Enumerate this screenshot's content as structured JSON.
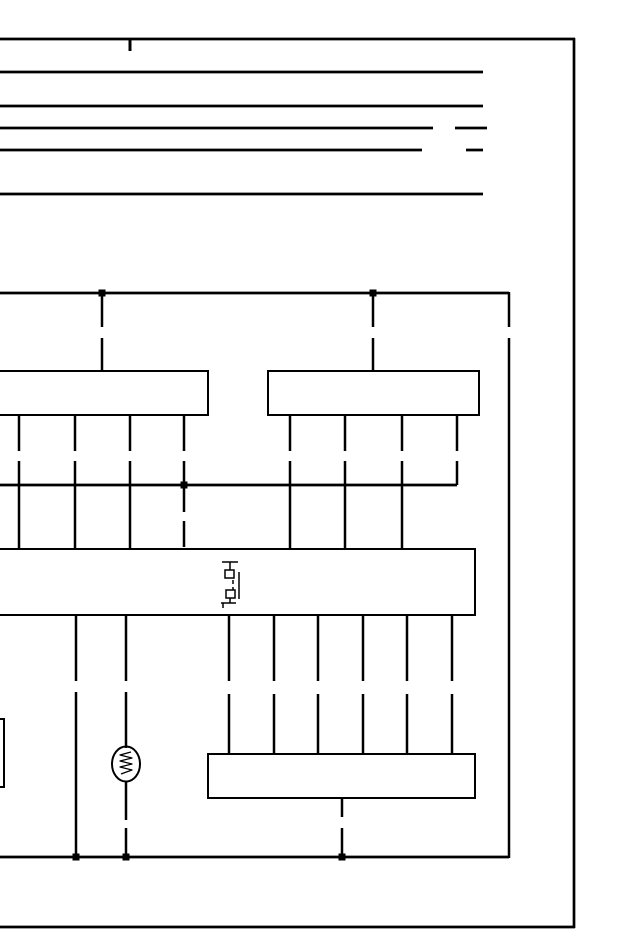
{
  "page": {
    "kind": "wiring-diagram-schematic",
    "background_color": "#ffffff",
    "line_color": "#000000"
  },
  "diagram": {
    "canvas": {
      "width": 640,
      "height": 950
    },
    "elements": [
      {
        "name": "page-border-top",
        "type": "line",
        "x1": 0,
        "y1": 39,
        "x2": 575,
        "y2": 39,
        "sw": 2.7
      },
      {
        "name": "page-border-right",
        "type": "line",
        "x1": 574,
        "y1": 38,
        "x2": 574,
        "y2": 928,
        "sw": 2.7
      },
      {
        "name": "page-border-bottom",
        "type": "line",
        "x1": 0,
        "y1": 927,
        "x2": 575,
        "y2": 927,
        "sw": 2.7
      },
      {
        "name": "top-border-tick",
        "type": "line",
        "x1": 130,
        "y1": 39,
        "x2": 130,
        "y2": 51,
        "sw": 3
      },
      {
        "name": "bus-line-1",
        "type": "line",
        "x1": 0,
        "y1": 72,
        "x2": 483,
        "y2": 72,
        "sw": 2.7
      },
      {
        "name": "bus-line-2",
        "type": "line",
        "x1": 0,
        "y1": 106,
        "x2": 483,
        "y2": 106,
        "sw": 2.7
      },
      {
        "name": "bus-line-3",
        "type": "line",
        "x1": 0,
        "y1": 128,
        "x2": 433,
        "y2": 128,
        "sw": 2.7
      },
      {
        "name": "bus-line-3-dash",
        "type": "line",
        "x1": 455,
        "y1": 128,
        "x2": 487,
        "y2": 128,
        "sw": 2.7
      },
      {
        "name": "bus-line-4",
        "type": "line",
        "x1": 0,
        "y1": 150,
        "x2": 422,
        "y2": 150,
        "sw": 2.7
      },
      {
        "name": "bus-line-4-dash",
        "type": "line",
        "x1": 466,
        "y1": 150,
        "x2": 483,
        "y2": 150,
        "sw": 2.7
      },
      {
        "name": "bus-line-5",
        "type": "line",
        "x1": 0,
        "y1": 194,
        "x2": 483,
        "y2": 194,
        "sw": 2.7
      },
      {
        "name": "main-feed-wire",
        "type": "line",
        "x1": 0,
        "y1": 293,
        "x2": 509,
        "y2": 293,
        "sw": 2.7
      },
      {
        "name": "feed-drop-left",
        "type": "line",
        "x1": 102,
        "y1": 294,
        "x2": 102,
        "y2": 371,
        "sw": 2.5,
        "dash": "33 11"
      },
      {
        "name": "feed-drop-right",
        "type": "line",
        "x1": 373,
        "y1": 294,
        "x2": 373,
        "y2": 371,
        "sw": 2.5,
        "dash": "33 11"
      },
      {
        "name": "right-trunk-wire-upper",
        "type": "line",
        "x1": 509,
        "y1": 292,
        "x2": 509,
        "y2": 327,
        "sw": 2.5
      },
      {
        "name": "right-trunk-wire",
        "type": "line",
        "x1": 509,
        "y1": 338,
        "x2": 509,
        "y2": 858,
        "sw": 2.5
      },
      {
        "name": "junction-dot-feed-left",
        "type": "dot",
        "x": 102,
        "y": 293,
        "s": 7
      },
      {
        "name": "junction-dot-feed-right",
        "type": "dot",
        "x": 373,
        "y": 293,
        "s": 7
      },
      {
        "name": "connector-box-left",
        "type": "rect",
        "x": -14,
        "y": 371,
        "w": 222,
        "h": 44,
        "sw": 2
      },
      {
        "name": "connector-box-right",
        "type": "rect",
        "x": 268,
        "y": 371,
        "w": 211,
        "h": 44,
        "sw": 2
      },
      {
        "name": "left-box-pin-1",
        "type": "line",
        "x1": 19,
        "y1": 415,
        "x2": 19,
        "y2": 485,
        "sw": 2.5,
        "dash": "36 10"
      },
      {
        "name": "left-box-pin-2",
        "type": "line",
        "x1": 75,
        "y1": 415,
        "x2": 75,
        "y2": 485,
        "sw": 2.5,
        "dash": "36 10"
      },
      {
        "name": "left-box-pin-3",
        "type": "line",
        "x1": 130,
        "y1": 415,
        "x2": 130,
        "y2": 485,
        "sw": 2.5,
        "dash": "36 10"
      },
      {
        "name": "left-box-pin-4",
        "type": "line",
        "x1": 184,
        "y1": 415,
        "x2": 184,
        "y2": 485,
        "sw": 2.5,
        "dash": "36 10"
      },
      {
        "name": "right-box-pin-1",
        "type": "line",
        "x1": 290,
        "y1": 415,
        "x2": 290,
        "y2": 485,
        "sw": 2.5,
        "dash": "36 10"
      },
      {
        "name": "right-box-pin-2",
        "type": "line",
        "x1": 345,
        "y1": 415,
        "x2": 345,
        "y2": 485,
        "sw": 2.5,
        "dash": "36 10"
      },
      {
        "name": "right-box-pin-3",
        "type": "line",
        "x1": 402,
        "y1": 415,
        "x2": 402,
        "y2": 485,
        "sw": 2.5,
        "dash": "36 10"
      },
      {
        "name": "right-box-pin-4",
        "type": "line",
        "x1": 457,
        "y1": 415,
        "x2": 457,
        "y2": 485,
        "sw": 2.5,
        "dash": "36 10"
      },
      {
        "name": "interconnect-wire",
        "type": "line",
        "x1": 0,
        "y1": 485,
        "x2": 457,
        "y2": 485,
        "sw": 2.7
      },
      {
        "name": "junction-dot-interconnect",
        "type": "dot",
        "x": 184,
        "y": 485,
        "s": 7
      },
      {
        "name": "drop-wire-1",
        "type": "line",
        "x1": 19,
        "y1": 486,
        "x2": 19,
        "y2": 549,
        "sw": 2.5
      },
      {
        "name": "drop-wire-2",
        "type": "line",
        "x1": 75,
        "y1": 486,
        "x2": 75,
        "y2": 549,
        "sw": 2.5
      },
      {
        "name": "drop-wire-3",
        "type": "line",
        "x1": 130,
        "y1": 486,
        "x2": 130,
        "y2": 549,
        "sw": 2.5
      },
      {
        "name": "drop-wire-dashed",
        "type": "line",
        "x1": 184,
        "y1": 486,
        "x2": 184,
        "y2": 549,
        "sw": 2.5,
        "dash": "26 9"
      },
      {
        "name": "drop-wire-4",
        "type": "line",
        "x1": 290,
        "y1": 486,
        "x2": 290,
        "y2": 549,
        "sw": 2.5
      },
      {
        "name": "drop-wire-5",
        "type": "line",
        "x1": 345,
        "y1": 486,
        "x2": 345,
        "y2": 549,
        "sw": 2.5
      },
      {
        "name": "drop-wire-6",
        "type": "line",
        "x1": 402,
        "y1": 486,
        "x2": 402,
        "y2": 549,
        "sw": 2.5
      },
      {
        "name": "main-connector-box",
        "type": "rect",
        "x": -14,
        "y": 549,
        "w": 489,
        "h": 66,
        "sw": 2
      },
      {
        "name": "inline-connector-top-bar",
        "type": "line",
        "x1": 222,
        "y1": 562,
        "x2": 238,
        "y2": 562,
        "sw": 1.5
      },
      {
        "name": "inline-connector-top-stub",
        "type": "line",
        "x1": 230,
        "y1": 562,
        "x2": 230,
        "y2": 570,
        "sw": 1.5
      },
      {
        "name": "inline-connector-terminal-upper",
        "type": "rect",
        "x": 225,
        "y": 570,
        "w": 9,
        "h": 8,
        "sw": 1.5
      },
      {
        "name": "inline-connector-link-dash",
        "type": "line",
        "x1": 233,
        "y1": 580,
        "x2": 233,
        "y2": 590,
        "sw": 1.5,
        "dash": "4 3"
      },
      {
        "name": "inline-connector-side-line",
        "type": "line",
        "x1": 239,
        "y1": 572,
        "x2": 239,
        "y2": 599,
        "sw": 1.5
      },
      {
        "name": "inline-connector-terminal-lower",
        "type": "rect",
        "x": 226,
        "y": 590,
        "w": 9,
        "h": 8,
        "sw": 1.5
      },
      {
        "name": "inline-connector-bottom-stub",
        "type": "line",
        "x1": 230,
        "y1": 598,
        "x2": 230,
        "y2": 603,
        "sw": 1.5
      },
      {
        "name": "inline-connector-foot",
        "type": "line",
        "x1": 221,
        "y1": 603,
        "x2": 236,
        "y2": 603,
        "sw": 1.5
      },
      {
        "name": "inline-connector-foot-tail",
        "type": "line",
        "x1": 223,
        "y1": 603,
        "x2": 223,
        "y2": 608,
        "sw": 1.5
      },
      {
        "name": "ground-branch-wire-upper",
        "type": "line",
        "x1": 76,
        "y1": 615,
        "x2": 76,
        "y2": 681,
        "sw": 2.5
      },
      {
        "name": "ground-branch-wire-lower",
        "type": "line",
        "x1": 76,
        "y1": 692,
        "x2": 76,
        "y2": 857,
        "sw": 2.5
      },
      {
        "name": "lamp-wire-upper",
        "type": "line",
        "x1": 126,
        "y1": 615,
        "x2": 126,
        "y2": 681,
        "sw": 2.5
      },
      {
        "name": "lamp-wire-mid",
        "type": "line",
        "x1": 126,
        "y1": 692,
        "x2": 126,
        "y2": 748,
        "sw": 2.5
      },
      {
        "name": "lamp-wire-lower",
        "type": "line",
        "x1": 126,
        "y1": 781,
        "x2": 126,
        "y2": 820,
        "sw": 2.5
      },
      {
        "name": "lamp-wire-tail",
        "type": "line",
        "x1": 126,
        "y1": 828,
        "x2": 126,
        "y2": 857,
        "sw": 2.5
      },
      {
        "name": "main-box-pin-1",
        "type": "line",
        "x1": 229,
        "y1": 615,
        "x2": 229,
        "y2": 754,
        "sw": 2.5,
        "dash": "66 13"
      },
      {
        "name": "main-box-pin-2",
        "type": "line",
        "x1": 274,
        "y1": 615,
        "x2": 274,
        "y2": 754,
        "sw": 2.5,
        "dash": "66 13"
      },
      {
        "name": "main-box-pin-3",
        "type": "line",
        "x1": 318,
        "y1": 615,
        "x2": 318,
        "y2": 754,
        "sw": 2.5,
        "dash": "66 13"
      },
      {
        "name": "main-box-pin-4",
        "type": "line",
        "x1": 363,
        "y1": 615,
        "x2": 363,
        "y2": 754,
        "sw": 2.5,
        "dash": "66 13"
      },
      {
        "name": "main-box-pin-5",
        "type": "line",
        "x1": 407,
        "y1": 615,
        "x2": 407,
        "y2": 754,
        "sw": 2.5,
        "dash": "66 13"
      },
      {
        "name": "main-box-pin-6",
        "type": "line",
        "x1": 452,
        "y1": 615,
        "x2": 452,
        "y2": 754,
        "sw": 2.5,
        "dash": "66 13"
      },
      {
        "name": "bulb-lamp-body",
        "type": "ellipse",
        "cx": 126,
        "cy": 764,
        "rx": 14,
        "ry": 17.5,
        "sw": 2
      },
      {
        "name": "bulb-lamp-filament",
        "type": "path",
        "d": "M131 752 L120 755 L132 758 L120 761 L132 764 L120 767 L132 770 L121 774",
        "sw": 1.3
      },
      {
        "name": "bottom-connector-box",
        "type": "rect",
        "x": 208,
        "y": 754,
        "w": 267,
        "h": 44,
        "sw": 2
      },
      {
        "name": "bottom-box-tail-upper",
        "type": "line",
        "x1": 342,
        "y1": 798,
        "x2": 342,
        "y2": 817,
        "sw": 2.5
      },
      {
        "name": "bottom-box-tail-lower",
        "type": "line",
        "x1": 342,
        "y1": 828,
        "x2": 342,
        "y2": 857,
        "sw": 2.5
      },
      {
        "name": "ground-rail",
        "type": "line",
        "x1": 0,
        "y1": 857,
        "x2": 509,
        "y2": 857,
        "sw": 2.7
      },
      {
        "name": "junction-dot-ground-1",
        "type": "dot",
        "x": 76,
        "y": 857,
        "s": 7
      },
      {
        "name": "junction-dot-ground-2",
        "type": "dot",
        "x": 126,
        "y": 857,
        "s": 7
      },
      {
        "name": "junction-dot-ground-3",
        "type": "dot",
        "x": 342,
        "y": 857,
        "s": 7
      },
      {
        "name": "left-edge-partial-box",
        "type": "rect",
        "x": -40,
        "y": 719,
        "w": 44,
        "h": 68,
        "sw": 2
      }
    ]
  }
}
